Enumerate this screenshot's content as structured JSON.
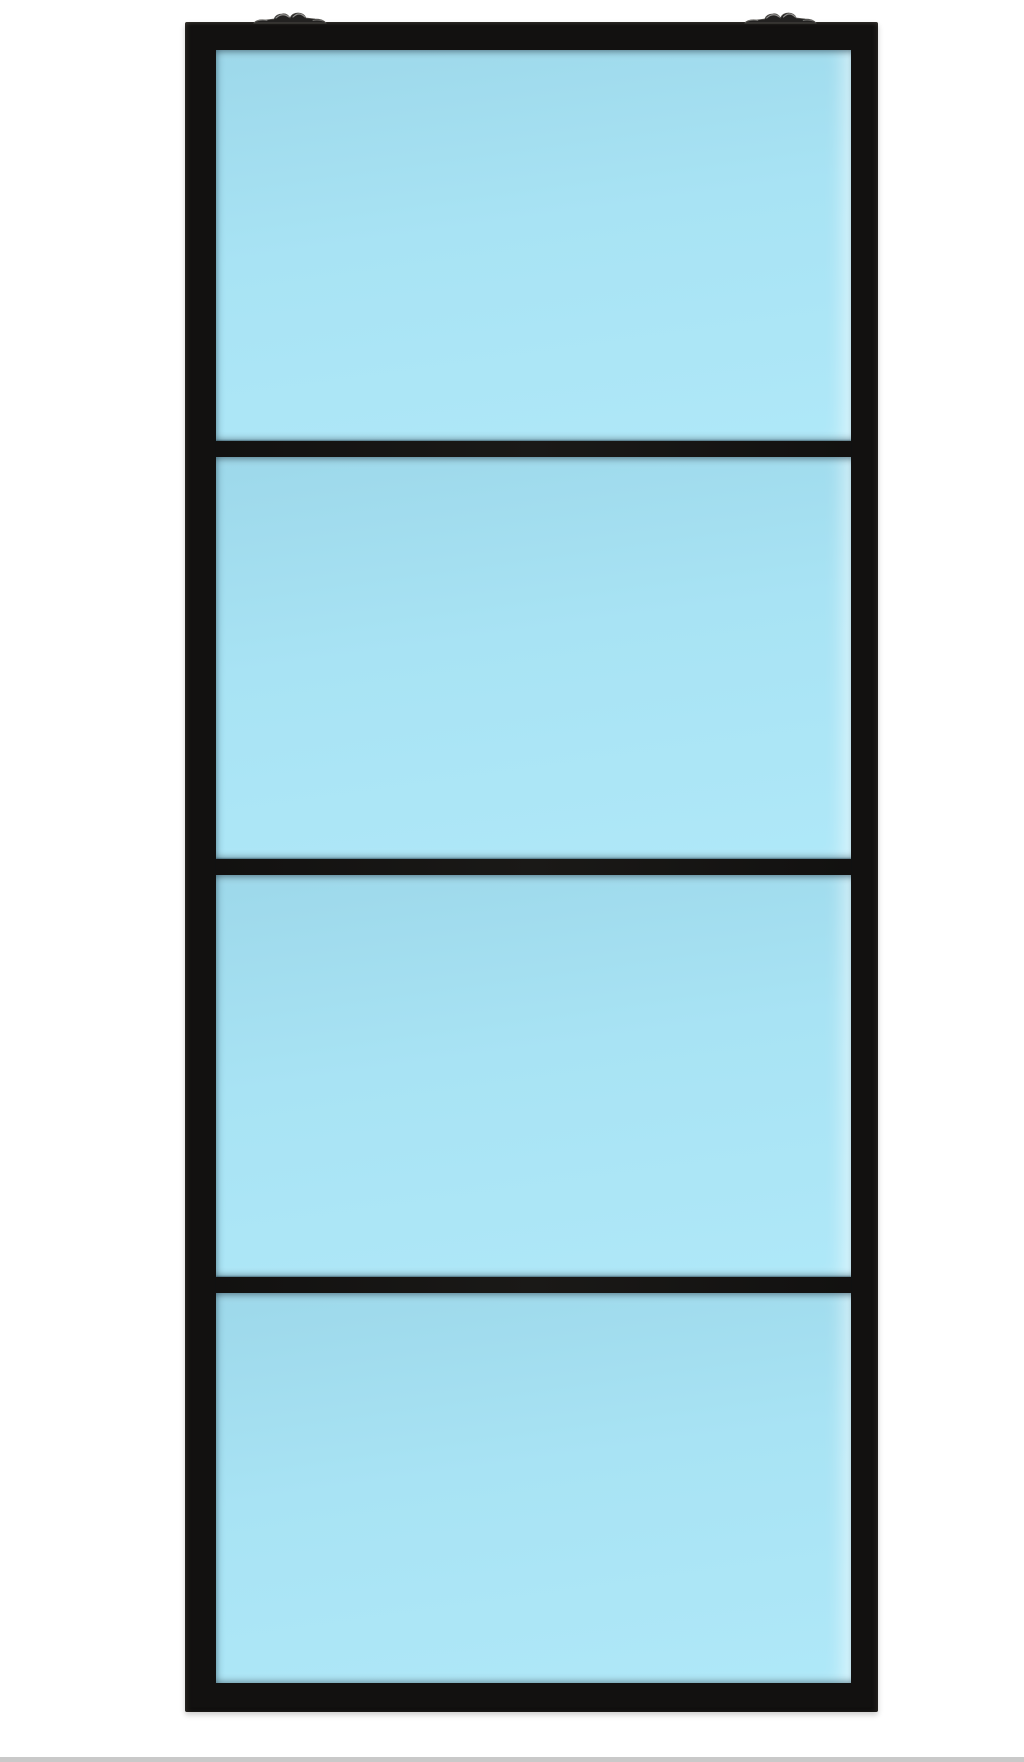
{
  "scene": {
    "description": "Product photo of a tall black metal-framed sliding door with four light blue glass panels and two roller brackets on the top edge, centered on a white background",
    "panel_count": 4
  },
  "colors": {
    "background": "#ffffff",
    "frame_color": "#121110",
    "glass_top": "#9dd8ea",
    "glass_mid": "#a8e3f4",
    "glass_bottom": "#afe8f8",
    "bracket_dark": "#232221",
    "bracket_edge": "#55534f",
    "bracket_highlight": "#8f8e8c",
    "footer_strip": "#c9c9c9"
  },
  "door": {
    "panels": [
      {
        "name": "glass-panel-1"
      },
      {
        "name": "glass-panel-2"
      },
      {
        "name": "glass-panel-3"
      },
      {
        "name": "glass-panel-4"
      }
    ],
    "brackets": [
      {
        "name": "roller-bracket-left",
        "side": "left"
      },
      {
        "name": "roller-bracket-right",
        "side": "right"
      }
    ]
  }
}
